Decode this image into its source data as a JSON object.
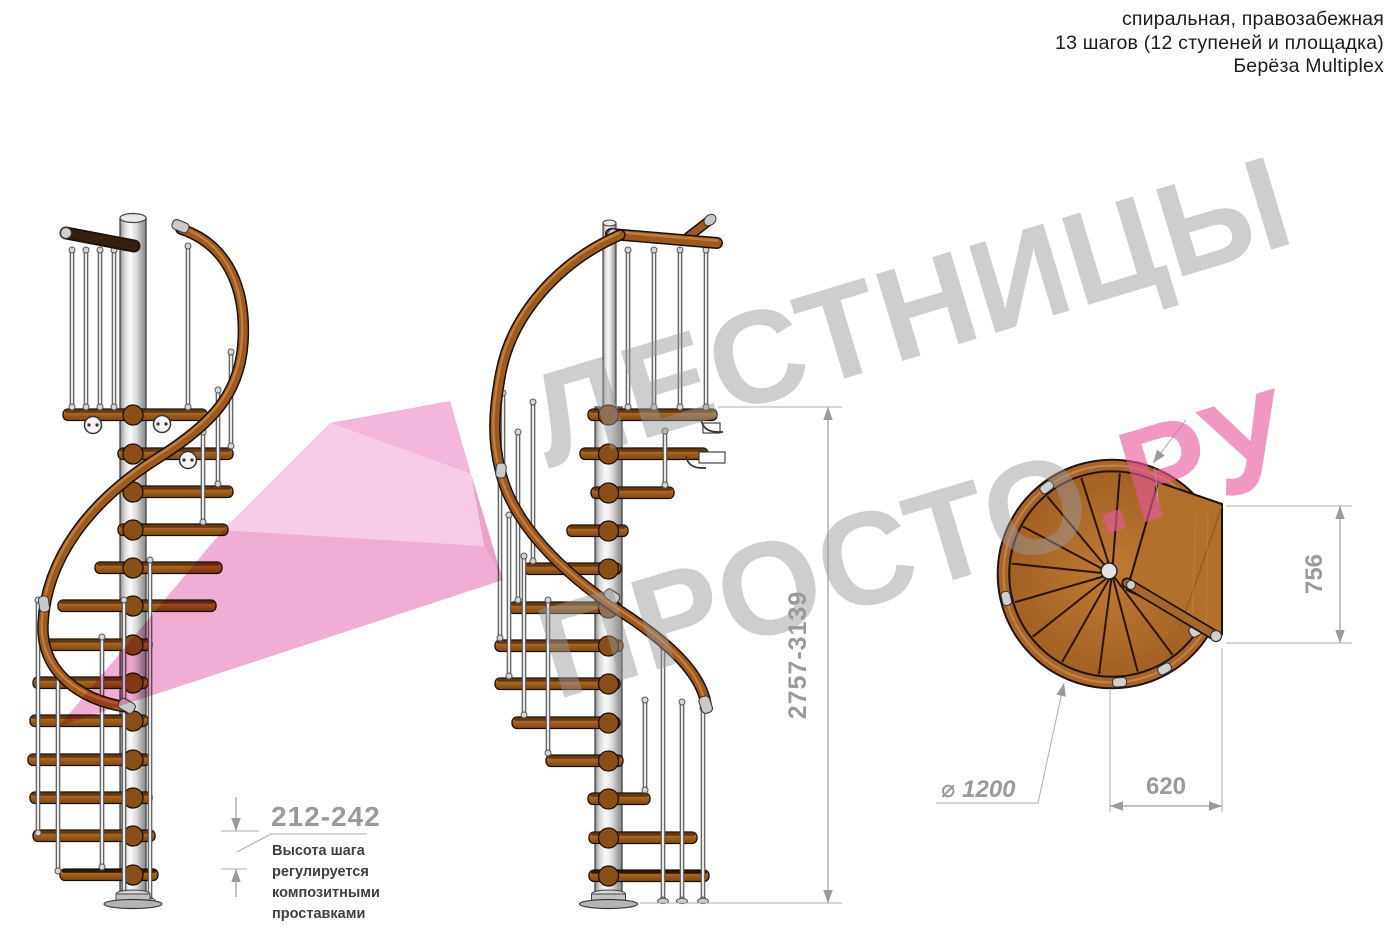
{
  "header": {
    "line1": "спиральная, правозабежная",
    "line2": "13 шагов (12 ступеней и площадка)",
    "line3": "Берёза Multiplex"
  },
  "watermark": {
    "line1": "ЛЕСТНИЦЫ",
    "line2_gray": "ПРОСТО",
    "line2_pink": ".РУ",
    "gray_color": "#999999",
    "pink_color": "#e7599d",
    "arrow_color": "#f2a9d2"
  },
  "dimensions": {
    "total_height": "2757-3139",
    "step_height": "212-242",
    "landing_depth": "756",
    "exit_width": "620",
    "diameter_label": "⌀ 1200"
  },
  "dim_note": {
    "lines": [
      "Высота шага",
      "регулируется",
      "композитными",
      "проставками"
    ]
  },
  "colors": {
    "wood": "#a9651f",
    "metal": "#d9d9d9",
    "dim_gray": "#9a9a9a"
  }
}
